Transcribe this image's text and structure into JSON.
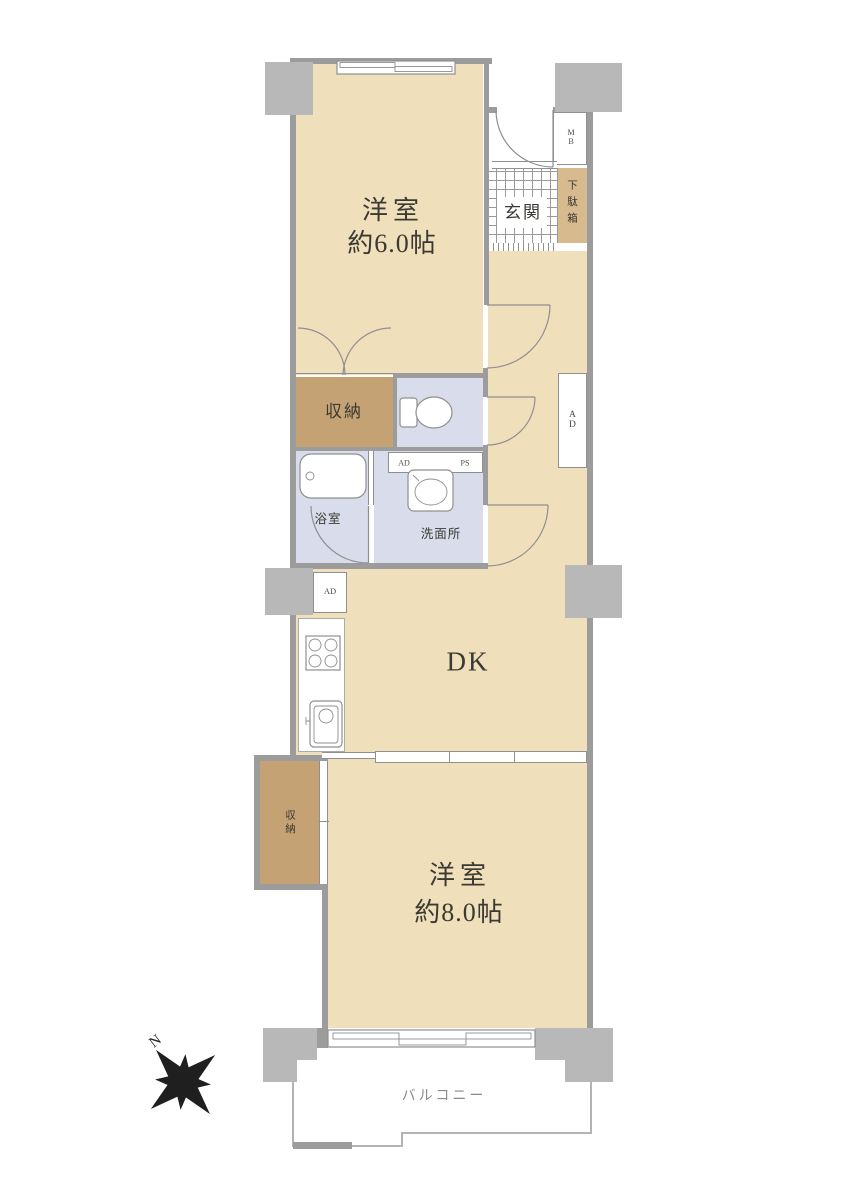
{
  "plan": {
    "rooms": {
      "western6": {
        "name": "洋室",
        "size": "約6.0帖"
      },
      "western8": {
        "name": "洋室",
        "size": "約8.0帖"
      },
      "dk": "DK",
      "entrance": "玄関",
      "shoe_cabinet": "下駄箱",
      "meter_box": "MB",
      "storage_upper": "収納",
      "storage_lower": "収納",
      "bathroom": "浴室",
      "washroom": "洗面所",
      "balcony": "バルコニー"
    },
    "ducts": {
      "hall_ad": "AD",
      "kitchen_ad": "AD",
      "strip_ad": "AD",
      "strip_ps": "PS"
    },
    "compass": {
      "north": "N"
    },
    "colors": {
      "floor_tan": "#f0dfbb",
      "closet_brown": "#c5a274",
      "cabinet_tan": "#d7ba8e",
      "wet_blue": "#d9ddeb",
      "wall_gray": "#9c9c9c",
      "pillar_gray": "#b8b8b9",
      "line_gray": "#8f8f8f",
      "text_dark": "#3a3a33",
      "text_gray": "#8a8a8a",
      "balcony_line": "#b3b3b3",
      "compass_black": "#1f1f1f"
    }
  }
}
